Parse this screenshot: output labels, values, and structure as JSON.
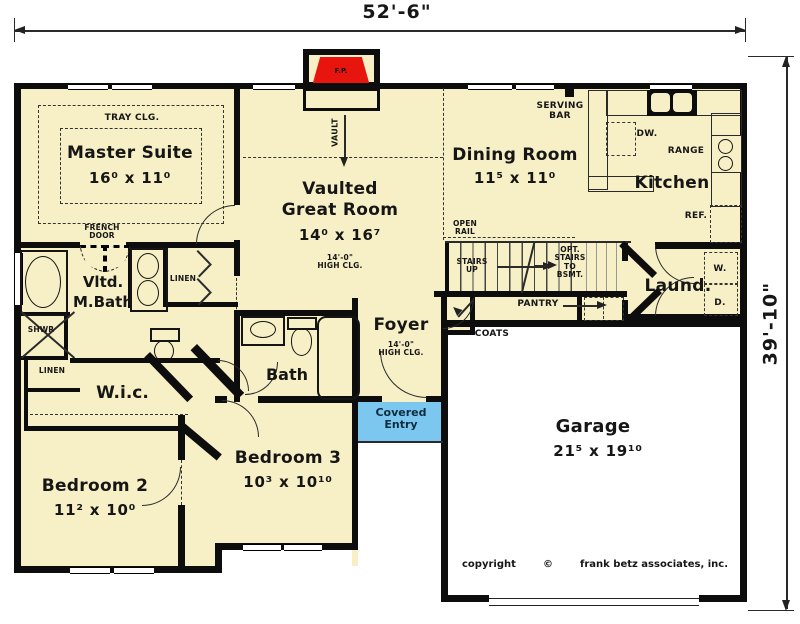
{
  "meta": {
    "width_dim": "52'-6\"",
    "height_dim": "39'-10\"",
    "fireplace": "F.P."
  },
  "rooms": {
    "master_suite": {
      "name": "Master Suite",
      "dims": "16⁰ x 11⁰",
      "ceiling": "TRAY CLG."
    },
    "great_room": {
      "line1": "Vaulted",
      "line2": "Great Room",
      "dims": "14⁰ x 16⁷",
      "clg1": "14'-0\"",
      "clg2": "HIGH CLG.",
      "vault": "VAULT"
    },
    "dining_room": {
      "name": "Dining Room",
      "dims": "11⁵ x 11⁰"
    },
    "kitchen": {
      "name": "Kitchen",
      "serving1": "SERVING",
      "serving2": "BAR",
      "dw": "DW.",
      "range": "RANGE",
      "ref": "REF."
    },
    "laundry": {
      "name": "Laund.",
      "washer": "W.",
      "dryer": "D."
    },
    "master_bath": {
      "line1": "Vltd.",
      "line2": "M.Bath",
      "shower": "SHWR",
      "linen": "LINEN"
    },
    "wic": {
      "name": "W.i.c.",
      "linen": "LINEN"
    },
    "bath": {
      "name": "Bath"
    },
    "foyer": {
      "name": "Foyer",
      "clg1": "14'-0\"",
      "clg2": "HIGH CLG."
    },
    "covered_entry": {
      "line1": "Covered",
      "line2": "Entry"
    },
    "bedroom2": {
      "name": "Bedroom 2",
      "dims": "11² x 10⁰"
    },
    "bedroom3": {
      "name": "Bedroom 3",
      "dims": "10³ x 10¹⁰"
    },
    "garage": {
      "name": "Garage",
      "dims": "21⁵ x 19¹⁰"
    }
  },
  "annotations": {
    "french1": "FRENCH",
    "french2": "DOOR",
    "open_rail1": "OPEN",
    "open_rail2": "RAIL",
    "stairs1": "STAIRS",
    "stairs2": "UP",
    "opt1": "OPT.",
    "opt2": "STAIRS",
    "opt3": "TO",
    "opt4": "BSMT.",
    "pantry": "PANTRY",
    "coats": "COATS"
  },
  "footer": {
    "copyright": "copyright",
    "symbol": "©",
    "firm": "frank betz associates, inc."
  },
  "colors": {
    "room_fill": "#F7F0C6",
    "entry_fill": "#7CC7EF",
    "fireplace_fill": "#E8150F",
    "wall": "#0D0D0D"
  }
}
